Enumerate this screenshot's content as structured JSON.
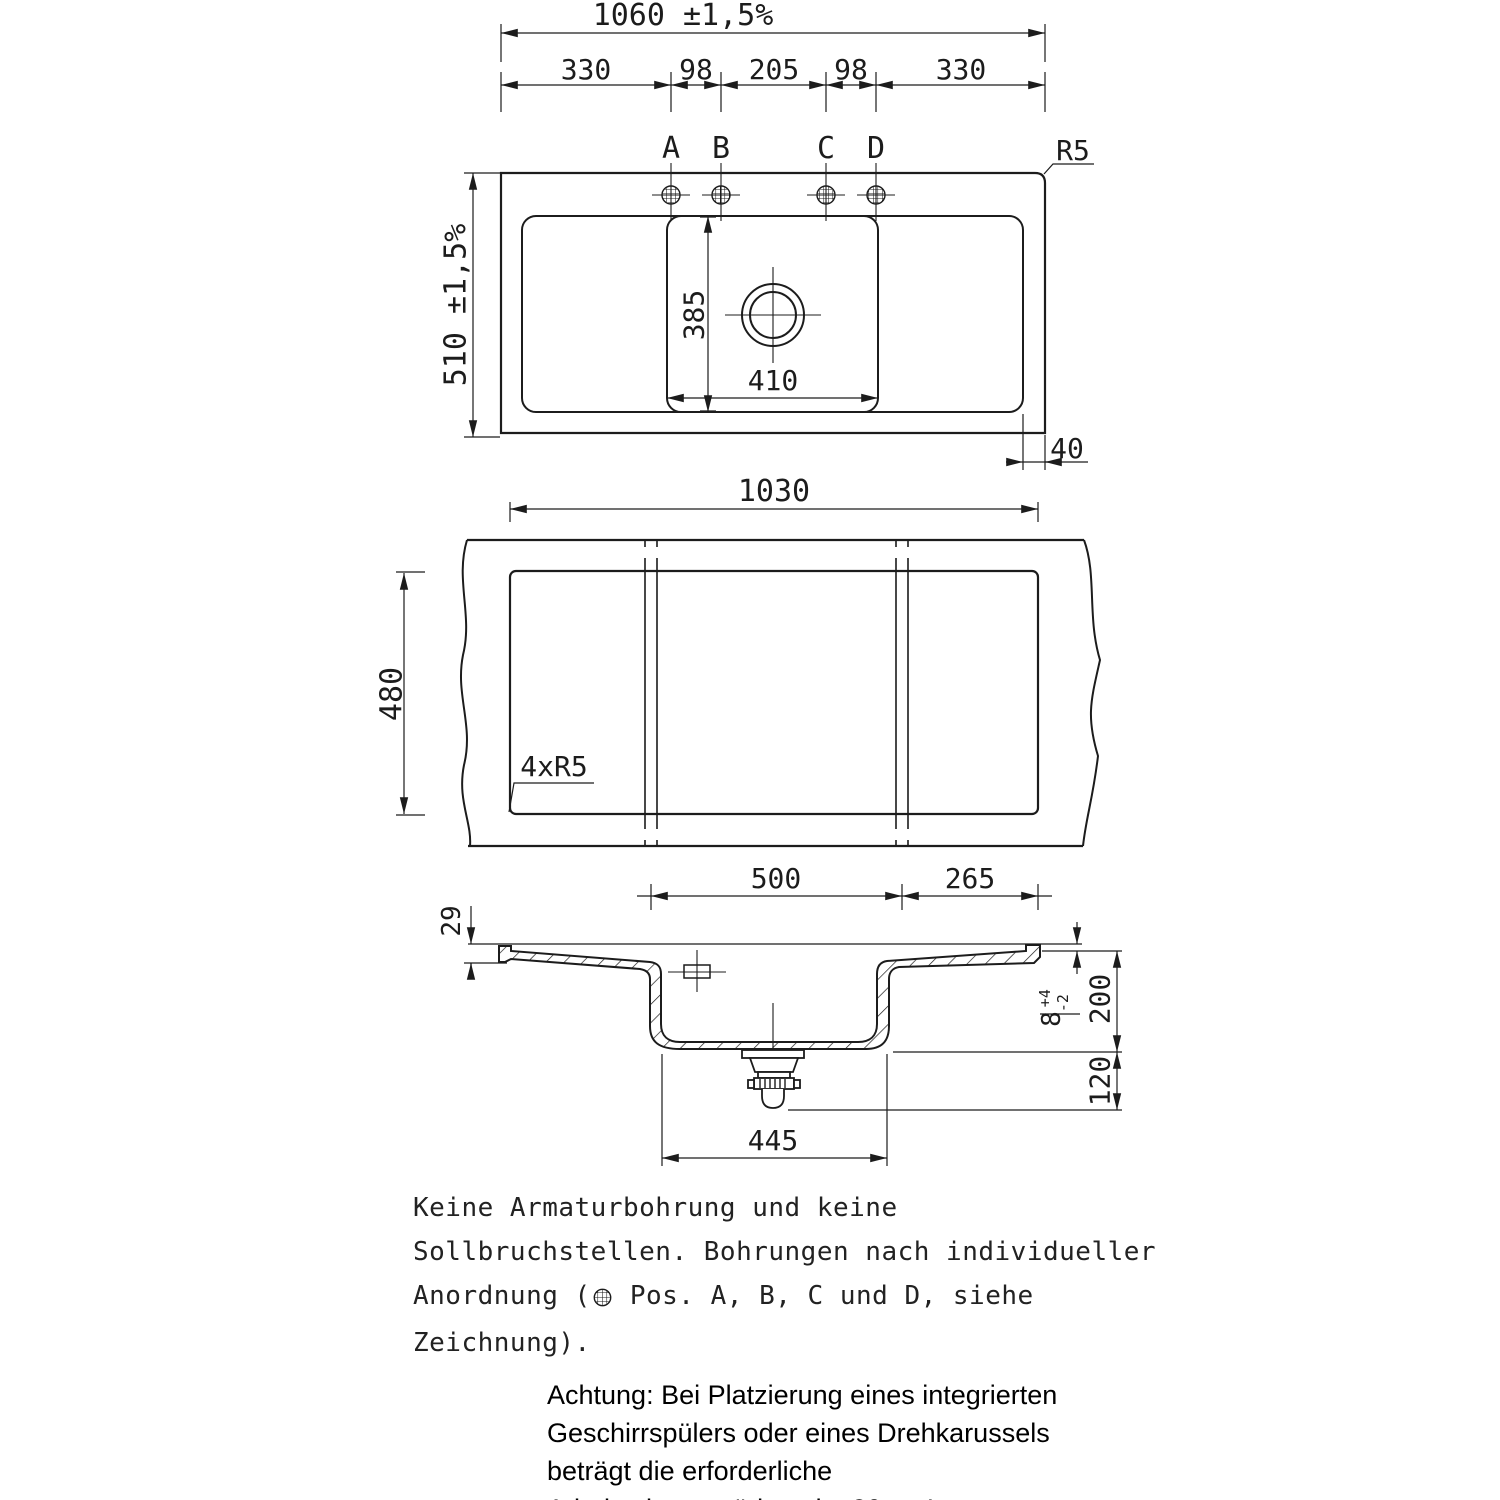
{
  "colors": {
    "line": "#1c1c1c",
    "background": "#ffffff"
  },
  "top_view": {
    "overall_width": "1060 ±1,5%",
    "overall_height": "510 ±1,5%",
    "segments": [
      "330",
      "98",
      "205",
      "98",
      "330"
    ],
    "holes": [
      "A",
      "B",
      "C",
      "D"
    ],
    "corner_radius": "R5",
    "basin_height_dim": "385",
    "basin_width_dim": "410",
    "edge_offset": "40"
  },
  "cutout_view": {
    "width": "1030",
    "height": "480",
    "corner_note": "4xR5",
    "offset_center": "500",
    "offset_right": "265"
  },
  "section_view": {
    "rim_thickness": "29",
    "rim_step": "8",
    "rim_step_tol_plus": "+4",
    "rim_step_tol_minus": "-2",
    "bowl_depth": "200",
    "drain_height": "120",
    "bowl_width": "445"
  },
  "notes": {
    "line1": "Keine Armaturbohrung und keine",
    "line2": "Sollbruchstellen. Bohrungen nach individueller",
    "line3_pre": "Anordnung (",
    "line3_post": " Pos. A, B, C und D, siehe",
    "line4": "Zeichnung)."
  },
  "warning": {
    "line1": "Achtung: Bei Platzierung eines integrierten",
    "line2": "Geschirrspülers oder eines Drehkarussels",
    "line3": "beträgt die erforderliche",
    "line4": "Arbeitsplattenstärke min. 30mm!"
  }
}
